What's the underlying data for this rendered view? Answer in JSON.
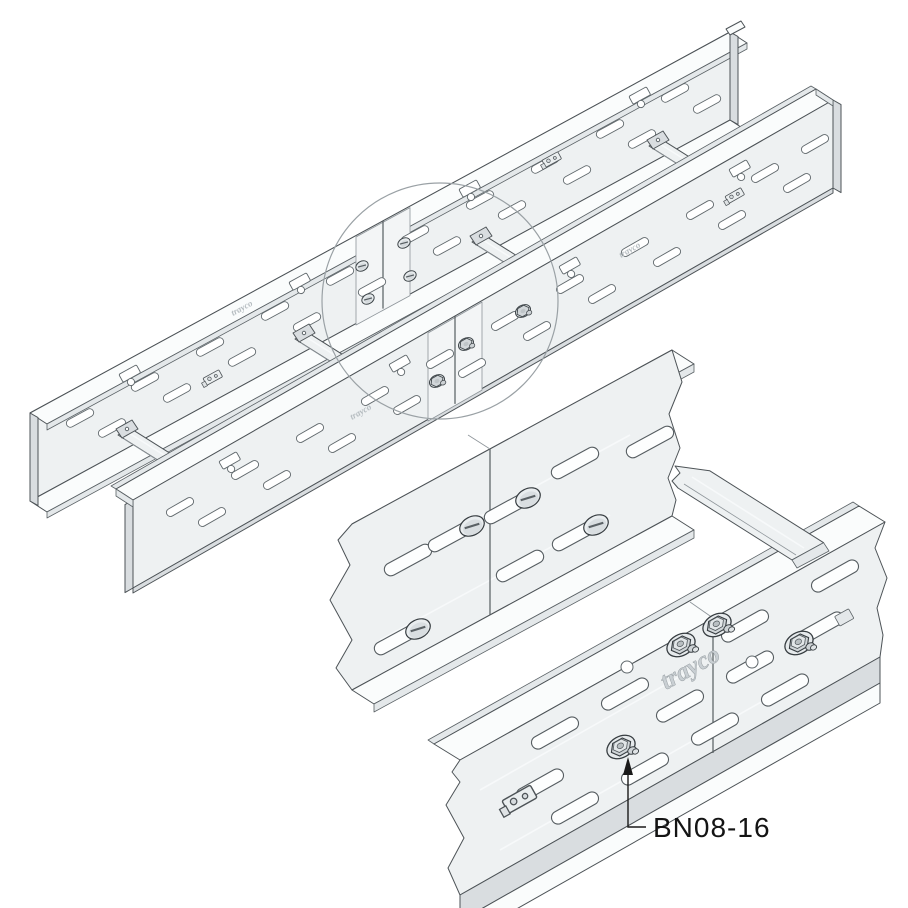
{
  "illustration": {
    "callout": {
      "part_number": "BN08-16"
    },
    "brand": {
      "logo_text": "trayco"
    },
    "colors": {
      "background": "#ffffff",
      "metal_face": "#eef1f2",
      "metal_light": "#fafcfc",
      "metal_mid": "#e4e8ea",
      "metal_dark": "#d9dde0",
      "outline": "#4d5357",
      "outline_soft": "#8e959a",
      "slot_fill": "#ffffff",
      "detail_circle": "#9aa1a5",
      "label_text": "#141414"
    }
  }
}
